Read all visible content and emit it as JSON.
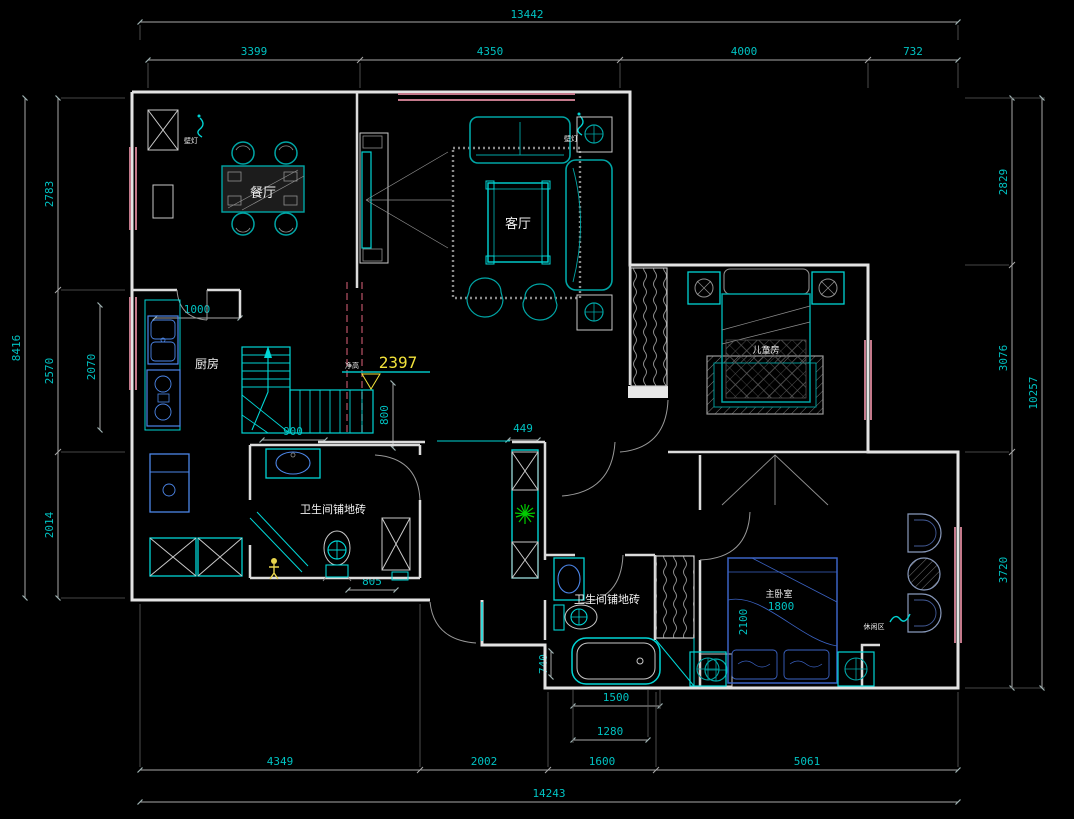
{
  "app": {
    "title": "residential floor plan CAD drawing"
  },
  "colors": {
    "background": "#000000",
    "wall": "#E3E3E3",
    "furniture_cyan": "#00D5D5",
    "fixture_blue": "#4C86E8",
    "window_pink": "#C4798B",
    "dimension_text": "#00C2C2",
    "highlight_yellow": "#FFF200",
    "plant_green": "#00CC00",
    "label_white": "#F2F2F2",
    "dashed_axis": "#A04858"
  },
  "labels": {
    "dining": "餐厅",
    "living": "客厅",
    "kitchen": "厨房",
    "bath1": "卫生间铺地砖",
    "bath2": "卫生间铺地砖",
    "kids_room": "儿童房",
    "master_room": "主卧室",
    "leisure": "休闲区",
    "wall_lamp_left": "壁灯",
    "wall_lamp_right": "壁灯",
    "height_prefix": "净高",
    "height_value": "2397"
  },
  "dims": {
    "top_total": "13442",
    "top_segs": [
      "3399",
      "4350",
      "4000",
      "732"
    ],
    "left_total": "8416",
    "left_segs": [
      "2783",
      "2570",
      "2014"
    ],
    "left_inner": "2070",
    "right_total": "10257",
    "right_segs": [
      "2829",
      "3076",
      "3720"
    ],
    "bottom_total": "14243",
    "bottom_segs": [
      "4349",
      "2002",
      "1600",
      "5061"
    ],
    "tub_length": "1500",
    "tub_inner": "1280",
    "tub_width": "740",
    "kitchen_opening": "1000",
    "stair_width": "800",
    "stair_run": "900",
    "hall_niche": "449",
    "bath1_width": "805",
    "bed_width": "1800",
    "bed_length": "2100"
  }
}
